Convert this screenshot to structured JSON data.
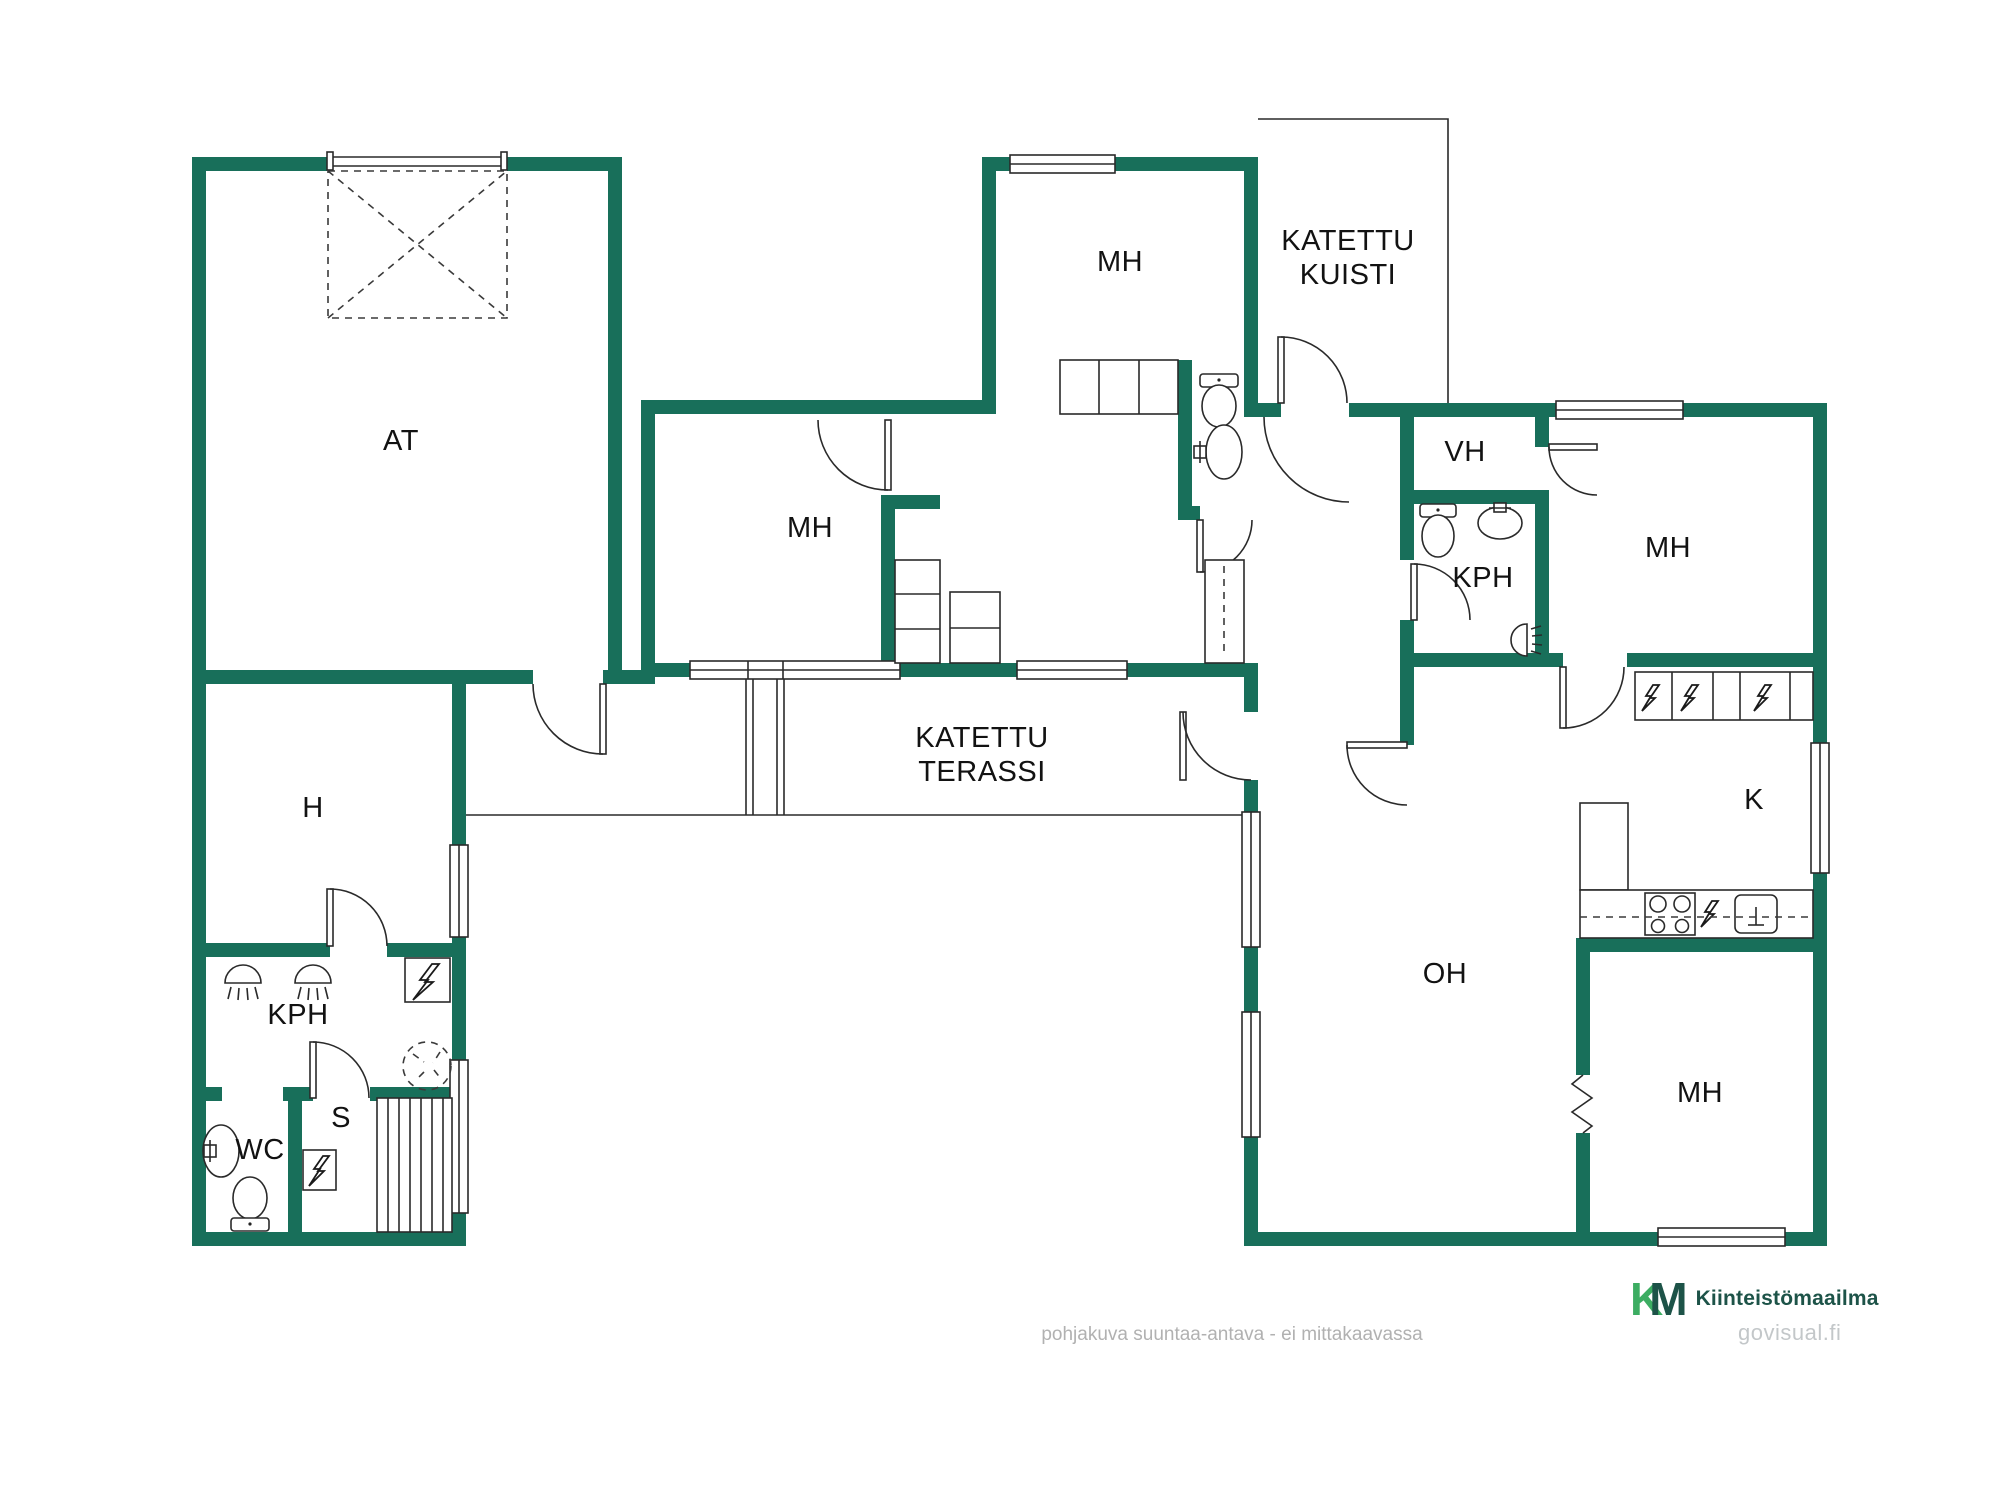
{
  "colors": {
    "wall": "#186F5A",
    "line": "#2a2a2a",
    "logo_green": "#3CAD62",
    "logo_dark": "#1D5348",
    "gray_text": "#B1B1B1",
    "watermark_gray": "#C3C7C9"
  },
  "rooms": [
    {
      "id": "at",
      "label": "AT",
      "x": 401,
      "y": 441
    },
    {
      "id": "mh-top",
      "label": "MH",
      "x": 1120,
      "y": 262
    },
    {
      "id": "katettu-kuisti",
      "label": "KATETTU\nKUISTI",
      "x": 1348,
      "y": 258
    },
    {
      "id": "mh-mid",
      "label": "MH",
      "x": 810,
      "y": 528
    },
    {
      "id": "vh",
      "label": "VH",
      "x": 1465,
      "y": 452
    },
    {
      "id": "kph-right",
      "label": "KPH",
      "x": 1483,
      "y": 578
    },
    {
      "id": "mh-right",
      "label": "MH",
      "x": 1668,
      "y": 548
    },
    {
      "id": "k",
      "label": "K",
      "x": 1754,
      "y": 800
    },
    {
      "id": "katettu-terassi",
      "label": "KATETTU\nTERASSI",
      "x": 982,
      "y": 755
    },
    {
      "id": "h",
      "label": "H",
      "x": 313,
      "y": 808
    },
    {
      "id": "kph-left",
      "label": "KPH",
      "x": 298,
      "y": 1015
    },
    {
      "id": "s",
      "label": "S",
      "x": 341,
      "y": 1118
    },
    {
      "id": "wc",
      "label": "WC",
      "x": 260,
      "y": 1150
    },
    {
      "id": "oh",
      "label": "OH",
      "x": 1445,
      "y": 974
    },
    {
      "id": "mh-bottom",
      "label": "MH",
      "x": 1700,
      "y": 1093
    }
  ],
  "symbols": [
    "garage-door",
    "driveway-dashed-area",
    "window",
    "door-swing-arc",
    "toilet",
    "washbasin",
    "shower-head",
    "sauna-benches",
    "sauna-stove",
    "electrical-panel",
    "floor-drain",
    "refrigerator",
    "oven",
    "dishwasher",
    "cooktop-4-burners",
    "kitchen-sink",
    "wardrobe-cabinets",
    "wall-opening-zigzag",
    "terrace-posts"
  ],
  "footer": {
    "disclaimer": "pohjakuva suuntaa-antava - ei mittakaavassa",
    "logo_k": "K",
    "logo_m": "M",
    "brand_name": "Kiinteistömaailma",
    "watermark": "govisual.fi"
  }
}
